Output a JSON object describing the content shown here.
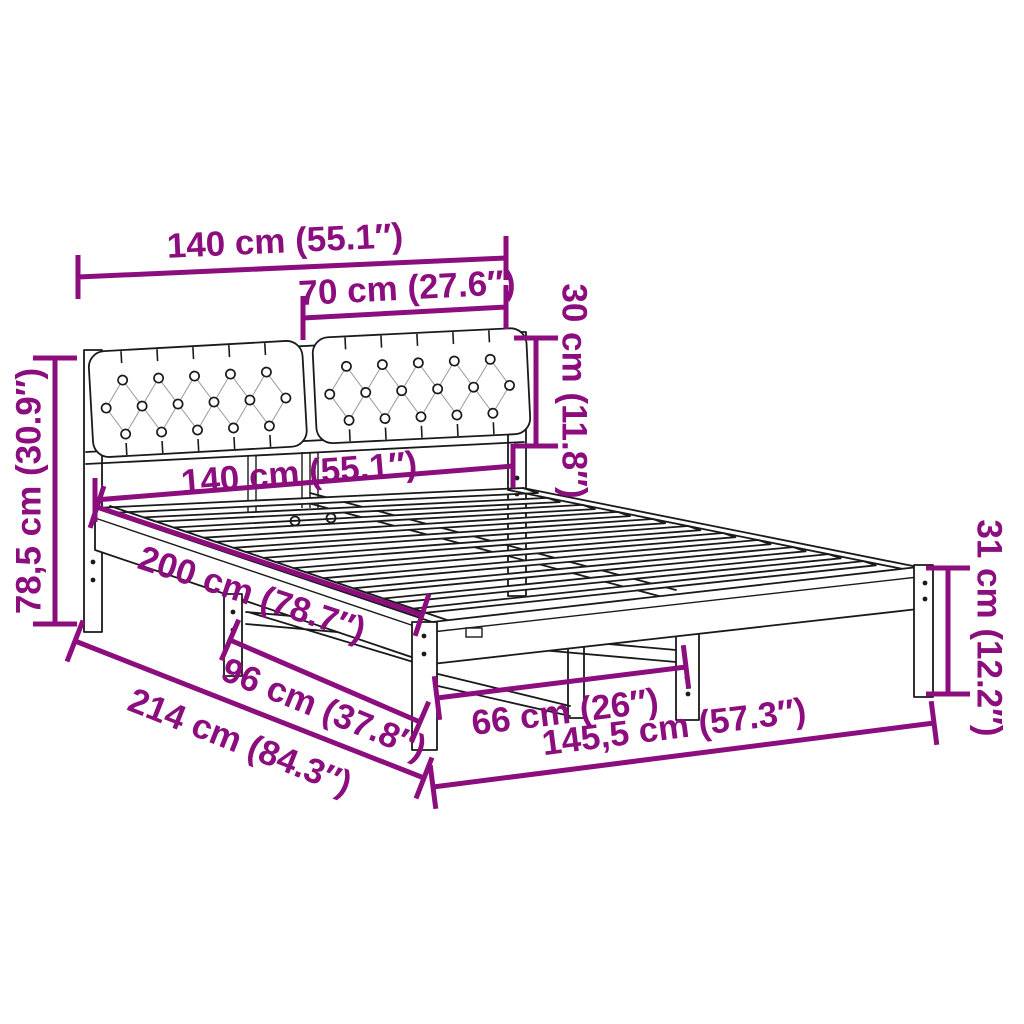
{
  "diagram": {
    "subject": "bed-frame-with-tufted-headboard",
    "colors": {
      "dimension": "#8b0d7e",
      "line_art": "#1a1a1a",
      "background": "#ffffff"
    },
    "dimensions": {
      "headboard_width": {
        "label": "140 cm (55.1″)"
      },
      "cushion_width": {
        "label": "70 cm (27.6″)"
      },
      "cushion_height": {
        "label": "30 cm (11.8″)"
      },
      "total_height": {
        "label": "78,5 cm (30.9″)"
      },
      "mattress_width": {
        "label": "140 cm (55.1″)"
      },
      "mattress_length": {
        "label": "200 cm (78.7″)"
      },
      "side_leg_spacing": {
        "label": "96 cm (37.8″)"
      },
      "total_length": {
        "label": "214 cm (84.3″)"
      },
      "foot_leg_spacing": {
        "label": "66 cm (26″)"
      },
      "total_width": {
        "label": "145,5 cm (57.3″)"
      },
      "base_height": {
        "label": "31 cm (12.2″)"
      }
    }
  }
}
